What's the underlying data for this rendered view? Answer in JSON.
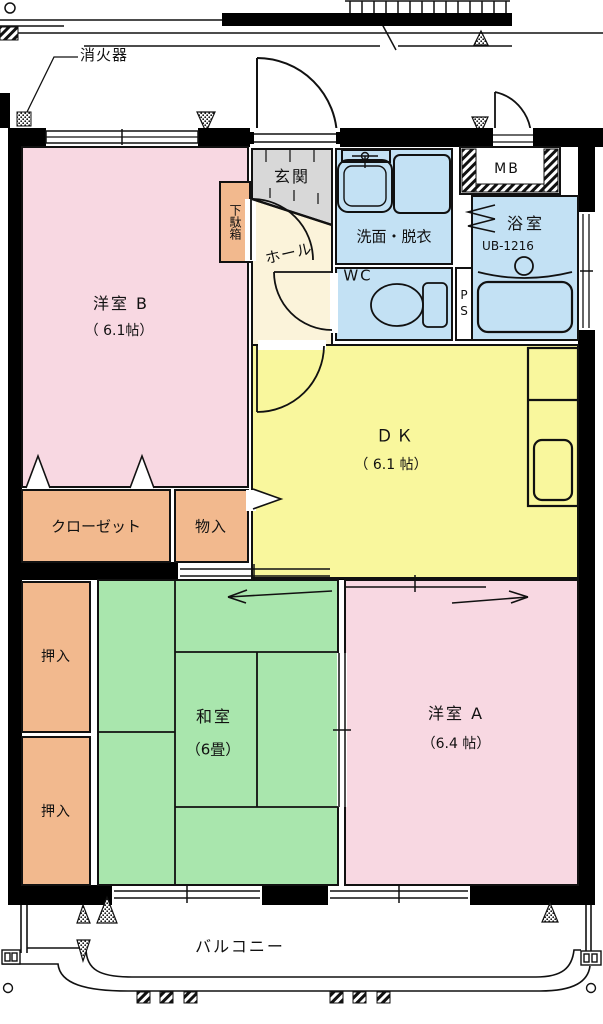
{
  "annotations": {
    "fire_extinguisher": "消火器"
  },
  "rooms": {
    "western_b": {
      "label": "洋室 B",
      "size": "（ 6.1帖）"
    },
    "dk": {
      "label": "ＤＫ",
      "size": "（ 6.1 帖）"
    },
    "japanese": {
      "label": "和室",
      "size": "（6畳）"
    },
    "western_a": {
      "label": "洋室 A",
      "size": "（6.4 帖）"
    },
    "genkan": {
      "label": "玄関"
    },
    "hall": {
      "label": "ホール"
    },
    "washroom": {
      "label": "洗面・脱衣"
    },
    "wc": {
      "label": "WC"
    },
    "bathroom": {
      "label": "浴室",
      "model": "UB-1216"
    },
    "balcony": {
      "label": "バルコニー"
    }
  },
  "storage": {
    "shoe_cabinet": "下駄箱",
    "closet": "クローゼット",
    "storage_box": "物入",
    "oshiire_upper": "押入",
    "oshiire_lower": "押入"
  },
  "utilities": {
    "meter_box": "MB",
    "pipe_space": "PS"
  },
  "colors": {
    "wall": "#000000",
    "room_pink": "#f8d8e2",
    "room_salmon": "#f2b98e",
    "room_yellow": "#f9f79d",
    "room_green": "#a9e6ad",
    "room_blue": "#c3e1f4",
    "room_cream": "#fbf3da",
    "genkan_gray": "#d8d8d8",
    "white": "#ffffff"
  }
}
